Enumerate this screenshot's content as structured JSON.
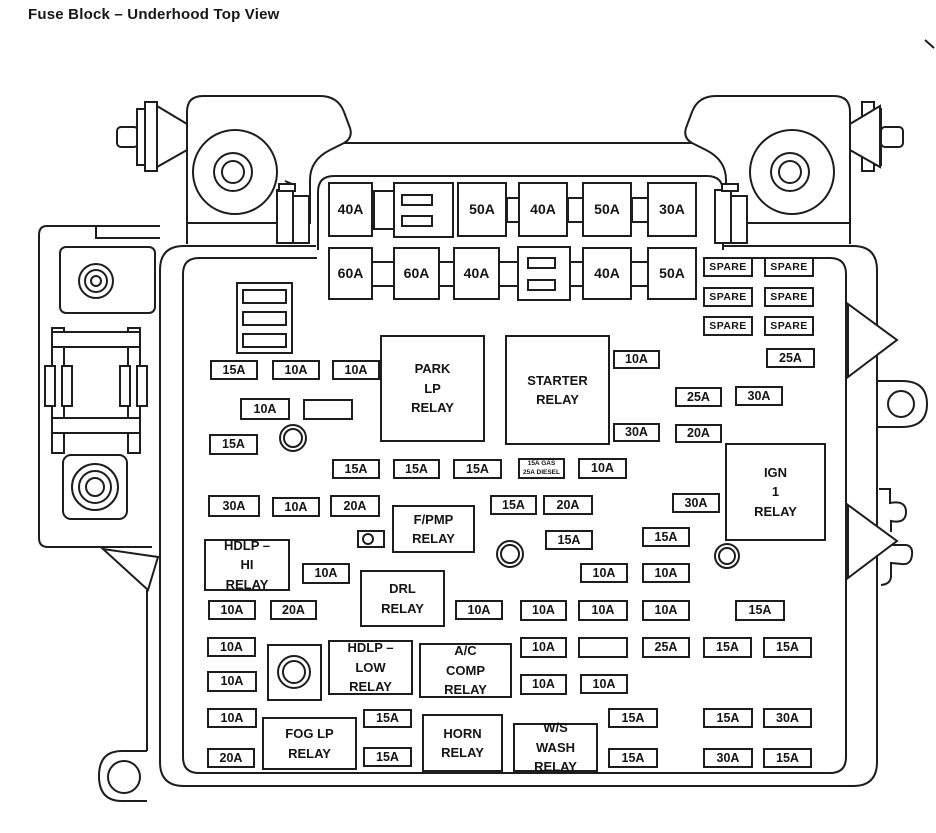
{
  "title": "Fuse Block – Underhood Top View",
  "colors": {
    "ink": "#1d1d1d",
    "background": "#ffffff"
  },
  "diagram": {
    "spare_label": "SPARE",
    "large_fuses": [
      {
        "label": "40A",
        "x": 328,
        "y": 182,
        "w": 45,
        "h": 55
      },
      {
        "label": "50A",
        "x": 457,
        "y": 182,
        "w": 50,
        "h": 55
      },
      {
        "label": "40A",
        "x": 518,
        "y": 182,
        "w": 50,
        "h": 55
      },
      {
        "label": "50A",
        "x": 582,
        "y": 182,
        "w": 50,
        "h": 55
      },
      {
        "label": "30A",
        "x": 647,
        "y": 182,
        "w": 50,
        "h": 55
      },
      {
        "label": "60A",
        "x": 328,
        "y": 247,
        "w": 45,
        "h": 53
      },
      {
        "label": "60A",
        "x": 393,
        "y": 247,
        "w": 47,
        "h": 53
      },
      {
        "label": "40A",
        "x": 453,
        "y": 247,
        "w": 47,
        "h": 53
      },
      {
        "label": "40A",
        "x": 582,
        "y": 247,
        "w": 50,
        "h": 53
      },
      {
        "label": "50A",
        "x": 647,
        "y": 247,
        "w": 50,
        "h": 53
      }
    ],
    "spares": [
      {
        "x": 703,
        "y": 257
      },
      {
        "x": 764,
        "y": 257
      },
      {
        "x": 703,
        "y": 287
      },
      {
        "x": 764,
        "y": 287
      },
      {
        "x": 703,
        "y": 316
      },
      {
        "x": 764,
        "y": 316
      }
    ],
    "small_fuses": [
      {
        "label": "25A",
        "x": 766,
        "y": 348,
        "w": 49,
        "h": 20
      },
      {
        "label": "10A",
        "x": 613,
        "y": 350,
        "w": 47,
        "h": 19
      },
      {
        "label": "25A",
        "x": 675,
        "y": 387,
        "w": 47,
        "h": 20
      },
      {
        "label": "30A",
        "x": 735,
        "y": 386,
        "w": 48,
        "h": 20
      },
      {
        "label": "30A",
        "x": 613,
        "y": 423,
        "w": 47,
        "h": 19
      },
      {
        "label": "20A",
        "x": 675,
        "y": 424,
        "w": 47,
        "h": 19
      },
      {
        "label": "15A",
        "x": 210,
        "y": 360
      },
      {
        "label": "10A",
        "x": 272,
        "y": 360
      },
      {
        "label": "10A",
        "x": 332,
        "y": 360
      },
      {
        "label": "10A",
        "x": 240,
        "y": 398,
        "w": 50,
        "h": 22
      },
      {
        "label": "",
        "x": 303,
        "y": 399,
        "w": 50,
        "h": 21
      },
      {
        "label": "15A",
        "x": 209,
        "y": 434,
        "w": 49,
        "h": 21
      },
      {
        "label": "15A",
        "x": 332,
        "y": 459
      },
      {
        "label": "15A",
        "x": 393,
        "y": 459,
        "w": 47
      },
      {
        "label": "15A",
        "x": 453,
        "y": 459,
        "w": 49
      },
      {
        "label": "10A",
        "x": 578,
        "y": 458,
        "w": 49,
        "h": 21
      },
      {
        "label": "30A",
        "x": 208,
        "y": 495,
        "w": 52,
        "h": 22
      },
      {
        "label": "10A",
        "x": 272,
        "y": 497
      },
      {
        "label": "20A",
        "x": 330,
        "y": 495,
        "w": 50,
        "h": 22
      },
      {
        "label": "15A",
        "x": 490,
        "y": 495,
        "w": 47
      },
      {
        "label": "20A",
        "x": 543,
        "y": 495,
        "w": 50
      },
      {
        "label": "30A",
        "x": 672,
        "y": 493
      },
      {
        "label": "15A",
        "x": 545,
        "y": 530
      },
      {
        "label": "15A",
        "x": 642,
        "y": 527
      },
      {
        "label": "10A",
        "x": 302,
        "y": 563,
        "h": 21
      },
      {
        "label": "10A",
        "x": 580,
        "y": 563
      },
      {
        "label": "10A",
        "x": 642,
        "y": 563
      },
      {
        "label": "10A",
        "x": 208,
        "y": 600
      },
      {
        "label": "20A",
        "x": 270,
        "y": 600,
        "w": 47
      },
      {
        "label": "10A",
        "x": 455,
        "y": 600
      },
      {
        "label": "10A",
        "x": 520,
        "y": 600,
        "w": 47,
        "h": 21
      },
      {
        "label": "10A",
        "x": 578,
        "y": 600,
        "w": 50,
        "h": 21
      },
      {
        "label": "10A",
        "x": 642,
        "y": 600,
        "h": 21
      },
      {
        "label": "15A",
        "x": 735,
        "y": 600,
        "w": 50,
        "h": 21
      },
      {
        "label": "10A",
        "x": 207,
        "y": 637,
        "w": 49
      },
      {
        "label": "10A",
        "x": 520,
        "y": 637,
        "w": 47,
        "h": 21
      },
      {
        "label": "",
        "x": 578,
        "y": 637,
        "w": 50,
        "h": 21
      },
      {
        "label": "25A",
        "x": 642,
        "y": 637,
        "h": 21
      },
      {
        "label": "15A",
        "x": 703,
        "y": 637,
        "w": 49,
        "h": 21
      },
      {
        "label": "15A",
        "x": 763,
        "y": 637,
        "w": 49,
        "h": 21
      },
      {
        "label": "10A",
        "x": 207,
        "y": 671,
        "w": 50,
        "h": 21
      },
      {
        "label": "10A",
        "x": 520,
        "y": 674,
        "w": 47,
        "h": 21
      },
      {
        "label": "10A",
        "x": 580,
        "y": 674
      },
      {
        "label": "10A",
        "x": 207,
        "y": 708,
        "w": 50
      },
      {
        "label": "15A",
        "x": 363,
        "y": 709,
        "w": 49,
        "h": 19
      },
      {
        "label": "15A",
        "x": 608,
        "y": 708,
        "w": 50
      },
      {
        "label": "15A",
        "x": 703,
        "y": 708,
        "w": 50
      },
      {
        "label": "30A",
        "x": 763,
        "y": 708,
        "w": 49
      },
      {
        "label": "20A",
        "x": 207,
        "y": 748
      },
      {
        "label": "15A",
        "x": 363,
        "y": 747,
        "w": 49
      },
      {
        "label": "15A",
        "x": 608,
        "y": 748,
        "w": 50
      },
      {
        "label": "30A",
        "x": 703,
        "y": 748,
        "w": 50
      },
      {
        "label": "15A",
        "x": 763,
        "y": 748,
        "w": 49
      }
    ],
    "relays": [
      {
        "id": "park-lp",
        "lines": [
          "PARK",
          "LP",
          "RELAY"
        ],
        "x": 380,
        "y": 335,
        "w": 105,
        "h": 107
      },
      {
        "id": "starter",
        "lines": [
          "STARTER",
          "RELAY"
        ],
        "x": 505,
        "y": 335,
        "w": 105,
        "h": 110
      },
      {
        "id": "ign-1",
        "lines": [
          "IGN",
          "1",
          "RELAY"
        ],
        "x": 725,
        "y": 443,
        "w": 101,
        "h": 98
      },
      {
        "id": "f-pmp",
        "lines": [
          "F/PMP",
          "RELAY"
        ],
        "x": 392,
        "y": 505,
        "w": 83,
        "h": 48
      },
      {
        "id": "hdlp-hi",
        "lines": [
          "HDLP –",
          "HI",
          "RELAY"
        ],
        "x": 204,
        "y": 539,
        "w": 86,
        "h": 52
      },
      {
        "id": "drl",
        "lines": [
          "DRL",
          "RELAY"
        ],
        "x": 360,
        "y": 570,
        "w": 85,
        "h": 57
      },
      {
        "id": "hdlp-low",
        "lines": [
          "HDLP –",
          "LOW",
          "RELAY"
        ],
        "x": 328,
        "y": 640,
        "w": 85,
        "h": 55
      },
      {
        "id": "ac-comp",
        "lines": [
          "A/C",
          "COMP",
          "RELAY"
        ],
        "x": 419,
        "y": 643,
        "w": 93,
        "h": 55
      },
      {
        "id": "fog-lp",
        "lines": [
          "FOG LP",
          "RELAY"
        ],
        "x": 262,
        "y": 717,
        "w": 95,
        "h": 53
      },
      {
        "id": "horn",
        "lines": [
          "HORN",
          "RELAY"
        ],
        "x": 422,
        "y": 714,
        "w": 81,
        "h": 58
      },
      {
        "id": "ws-wash",
        "lines": [
          "W/S",
          "WASH",
          "RELAY"
        ],
        "x": 513,
        "y": 723,
        "w": 85,
        "h": 49
      }
    ],
    "note_fuse": {
      "lines": [
        "15A GAS",
        "25A DIESEL"
      ],
      "x": 518,
      "y": 458,
      "w": 47,
      "h": 21
    }
  }
}
